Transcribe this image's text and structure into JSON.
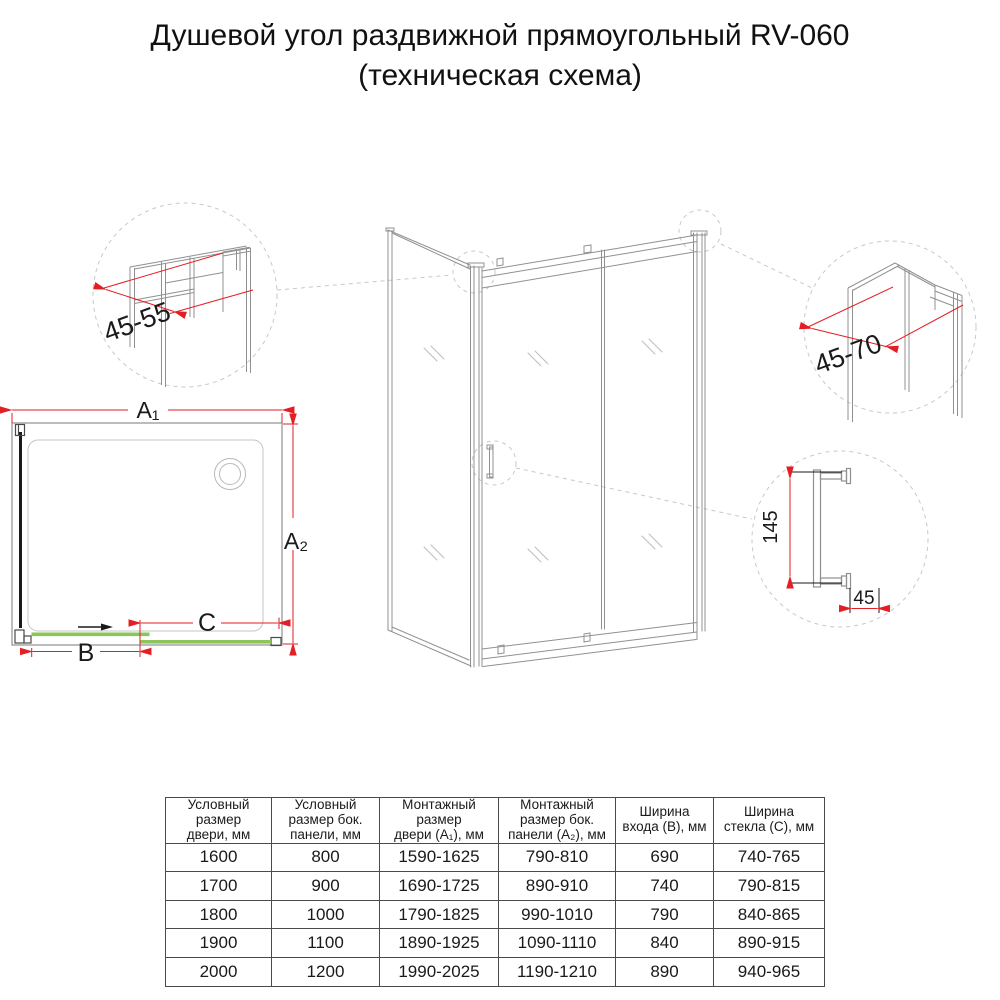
{
  "title": {
    "line1": "Душевой угол раздвижной прямоугольный RV-060",
    "line2": "(техническая схема)"
  },
  "colors": {
    "dimension_red": "#e31e24",
    "glass_green": "#8cc65a",
    "line_gray": "#909090",
    "dashed_gray": "#c8c8c8",
    "text_black": "#1a1a1a"
  },
  "plan_view": {
    "dim_a1": "A₁",
    "dim_a2": "A₂",
    "dim_b": "B",
    "dim_c": "C"
  },
  "details": {
    "left_profile": {
      "label": "45-55"
    },
    "right_profile": {
      "label": "45-70"
    },
    "handle": {
      "height": "145",
      "depth": "45"
    }
  },
  "table": {
    "headers": [
      "Условный\nразмер\nдвери, мм",
      "Условный\nразмер бок.\nпанели, мм",
      "Монтажный\nразмер\nдвери (А₁), мм",
      "Монтажный\nразмер бок.\nпанели (А₂), мм",
      "Ширина\nвхода (В), мм",
      "Ширина\nстекла (С), мм"
    ],
    "rows": [
      [
        "1600",
        "800",
        "1590-1625",
        "790-810",
        "690",
        "740-765"
      ],
      [
        "1700",
        "900",
        "1690-1725",
        "890-910",
        "740",
        "790-815"
      ],
      [
        "1800",
        "1000",
        "1790-1825",
        "990-1010",
        "790",
        "840-865"
      ],
      [
        "1900",
        "1100",
        "1890-1925",
        "1090-1110",
        "840",
        "890-915"
      ],
      [
        "2000",
        "1200",
        "1990-2025",
        "1190-1210",
        "890",
        "940-965"
      ]
    ]
  }
}
